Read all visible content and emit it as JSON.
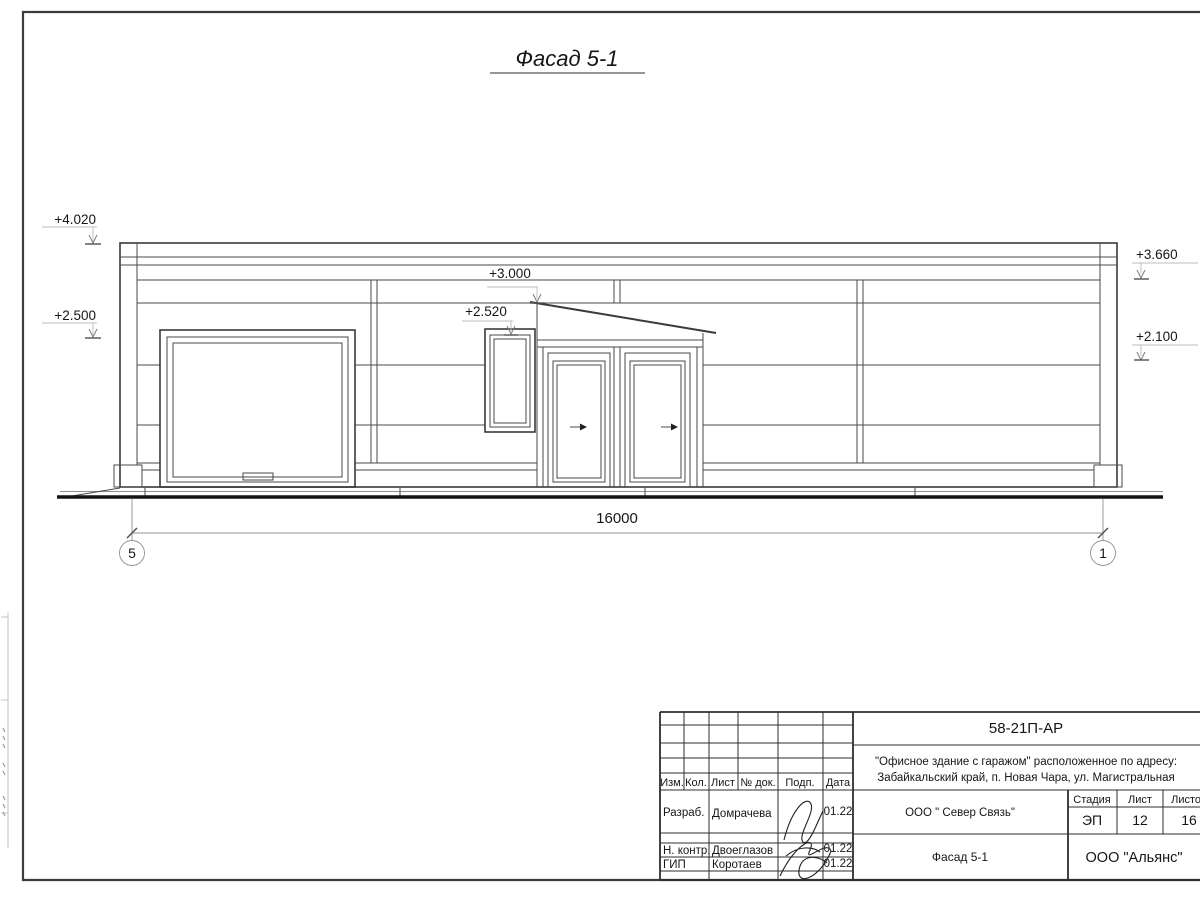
{
  "drawing": {
    "title": "Фасад 5-1",
    "elevation_marks": [
      {
        "name": "parapet-left",
        "value": "+4.020"
      },
      {
        "name": "level-left",
        "value": "+2.500"
      },
      {
        "name": "canopy-peak",
        "value": "+3.000"
      },
      {
        "name": "window-head",
        "value": "+2.520"
      },
      {
        "name": "parapet-right",
        "value": "+3.660"
      },
      {
        "name": "level-right",
        "value": "+2.100"
      }
    ],
    "dimension": {
      "value": "16000"
    },
    "axes": [
      {
        "label": "5"
      },
      {
        "label": "1"
      }
    ]
  },
  "title_block": {
    "doc_number": "58-21П-АР",
    "address_line1": "\"Офисное здание с гаражом\" расположенное по адресу:",
    "address_line2": "Забайкальский край, п. Новая Чара, ул. Магистральная",
    "columns": [
      "Изм.",
      "Кол.",
      "Лист",
      "№ док.",
      "Подп.",
      "Дата"
    ],
    "rows": [
      {
        "role": "Разраб.",
        "name": "Домрачева",
        "date": "01.22"
      },
      {
        "role": "Н. контр.",
        "name": "Двоеглазов",
        "date": "01.22"
      },
      {
        "role": "ГИП",
        "name": "Коротаев",
        "date": "01.22"
      }
    ],
    "company": "ООО \" Север Связь\"",
    "drawing_name": "Фасад 5-1",
    "stage_label": "Стадия",
    "sheet_label": "Лист",
    "sheets_label": "Листов",
    "stage": "ЭП",
    "sheet_no": "12",
    "sheets_total": "16",
    "org": "ООО \"Альянс\""
  }
}
